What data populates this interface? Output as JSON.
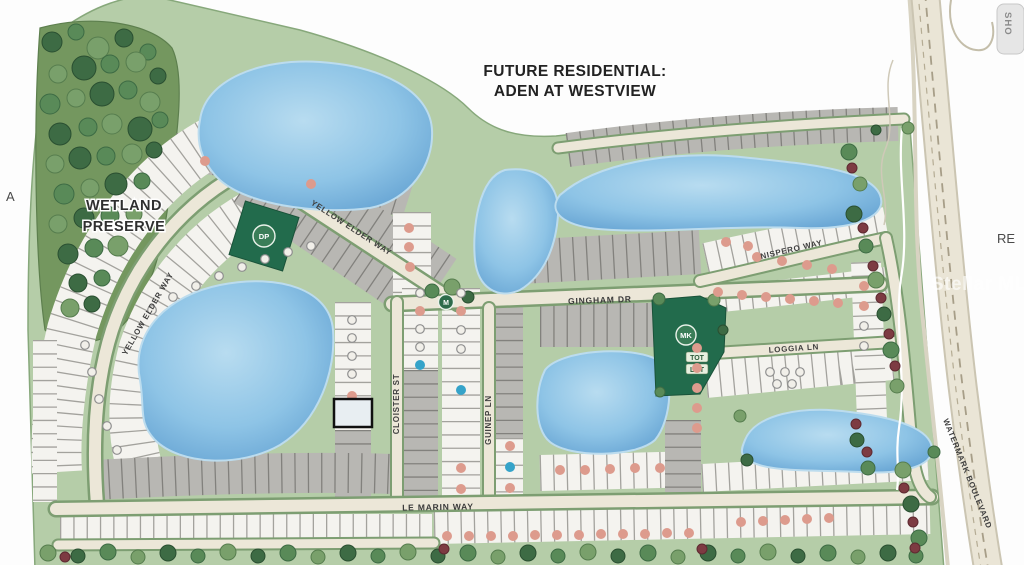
{
  "title": {
    "line1": "FUTURE RESIDENTIAL:",
    "line2": "ADEN AT WESTVIEW"
  },
  "areas": {
    "wetland": {
      "line1": "WETLAND",
      "line2": "PRESERVE"
    }
  },
  "streets": {
    "yellow_elder_upper": "YELLOW ELDER WAY",
    "yellow_elder_curve": "YELLOW ELDER WAY",
    "gingham": "GINGHAM DR",
    "nispero": "NISPERO WAY",
    "loggia": "LOGGIA LN",
    "cloister": "CLOISTER ST",
    "guinep": "GUINEP LN",
    "le_marin": "LE MARIN WAY",
    "watermark": "WATERMARK BOULEVARD"
  },
  "amenities": {
    "dog_park": "DP",
    "market": "MK",
    "tot_lot_line1": "TOT",
    "tot_lot_line2": "LOT",
    "m_icon": "M"
  },
  "edge_text": {
    "left": "A",
    "right": "RE",
    "corner_tab": "SHO"
  },
  "watermark_text": "Stellar MLS",
  "legend_colors": {
    "sold_dot": "#dd9b8d",
    "highlight_dot": "#35a3c9",
    "available_ring": "#8f8f8f",
    "community_green": "#b5cda8",
    "pond_blue": "#7fb8e0",
    "road_beige": "#ece7d8"
  },
  "highlight_lot": {
    "x": 334,
    "y": 399,
    "w": 38,
    "h": 28
  },
  "lot_markers": {
    "sold": [
      [
        205,
        161
      ],
      [
        311,
        184
      ],
      [
        409,
        228
      ],
      [
        409,
        247
      ],
      [
        410,
        267
      ],
      [
        352,
        396
      ],
      [
        420,
        311
      ],
      [
        461,
        311
      ],
      [
        461,
        468
      ],
      [
        461,
        489
      ],
      [
        510,
        446
      ],
      [
        510,
        488
      ],
      [
        560,
        470
      ],
      [
        585,
        470
      ],
      [
        610,
        469
      ],
      [
        635,
        468
      ],
      [
        660,
        468
      ],
      [
        697,
        348
      ],
      [
        697,
        368
      ],
      [
        697,
        388
      ],
      [
        697,
        408
      ],
      [
        697,
        428
      ],
      [
        726,
        242
      ],
      [
        748,
        246
      ],
      [
        757,
        257
      ],
      [
        782,
        261
      ],
      [
        807,
        265
      ],
      [
        832,
        269
      ],
      [
        718,
        292
      ],
      [
        742,
        295
      ],
      [
        766,
        297
      ],
      [
        790,
        299
      ],
      [
        814,
        301
      ],
      [
        838,
        303
      ],
      [
        864,
        286
      ],
      [
        864,
        306
      ],
      [
        447,
        536
      ],
      [
        469,
        536
      ],
      [
        491,
        536
      ],
      [
        513,
        536
      ],
      [
        535,
        535
      ],
      [
        557,
        535
      ],
      [
        579,
        535
      ],
      [
        601,
        534
      ],
      [
        623,
        534
      ],
      [
        645,
        534
      ],
      [
        667,
        533
      ],
      [
        689,
        533
      ],
      [
        741,
        522
      ],
      [
        763,
        521
      ],
      [
        785,
        520
      ],
      [
        807,
        519
      ],
      [
        829,
        518
      ]
    ],
    "available": [
      [
        152,
        310
      ],
      [
        173,
        297
      ],
      [
        196,
        286
      ],
      [
        219,
        276
      ],
      [
        242,
        267
      ],
      [
        265,
        259
      ],
      [
        288,
        252
      ],
      [
        311,
        246
      ],
      [
        85,
        345
      ],
      [
        92,
        372
      ],
      [
        99,
        399
      ],
      [
        107,
        426
      ],
      [
        117,
        450
      ],
      [
        352,
        320
      ],
      [
        352,
        338
      ],
      [
        352,
        356
      ],
      [
        352,
        374
      ],
      [
        420,
        293
      ],
      [
        420,
        329
      ],
      [
        420,
        347
      ],
      [
        461,
        293
      ],
      [
        461,
        330
      ],
      [
        461,
        349
      ],
      [
        770,
        372
      ],
      [
        785,
        372
      ],
      [
        800,
        372
      ],
      [
        777,
        384
      ],
      [
        792,
        384
      ],
      [
        864,
        326
      ],
      [
        864,
        346
      ]
    ],
    "highlight": [
      [
        353,
        413
      ],
      [
        420,
        365
      ],
      [
        461,
        390
      ],
      [
        510,
        467
      ]
    ]
  }
}
